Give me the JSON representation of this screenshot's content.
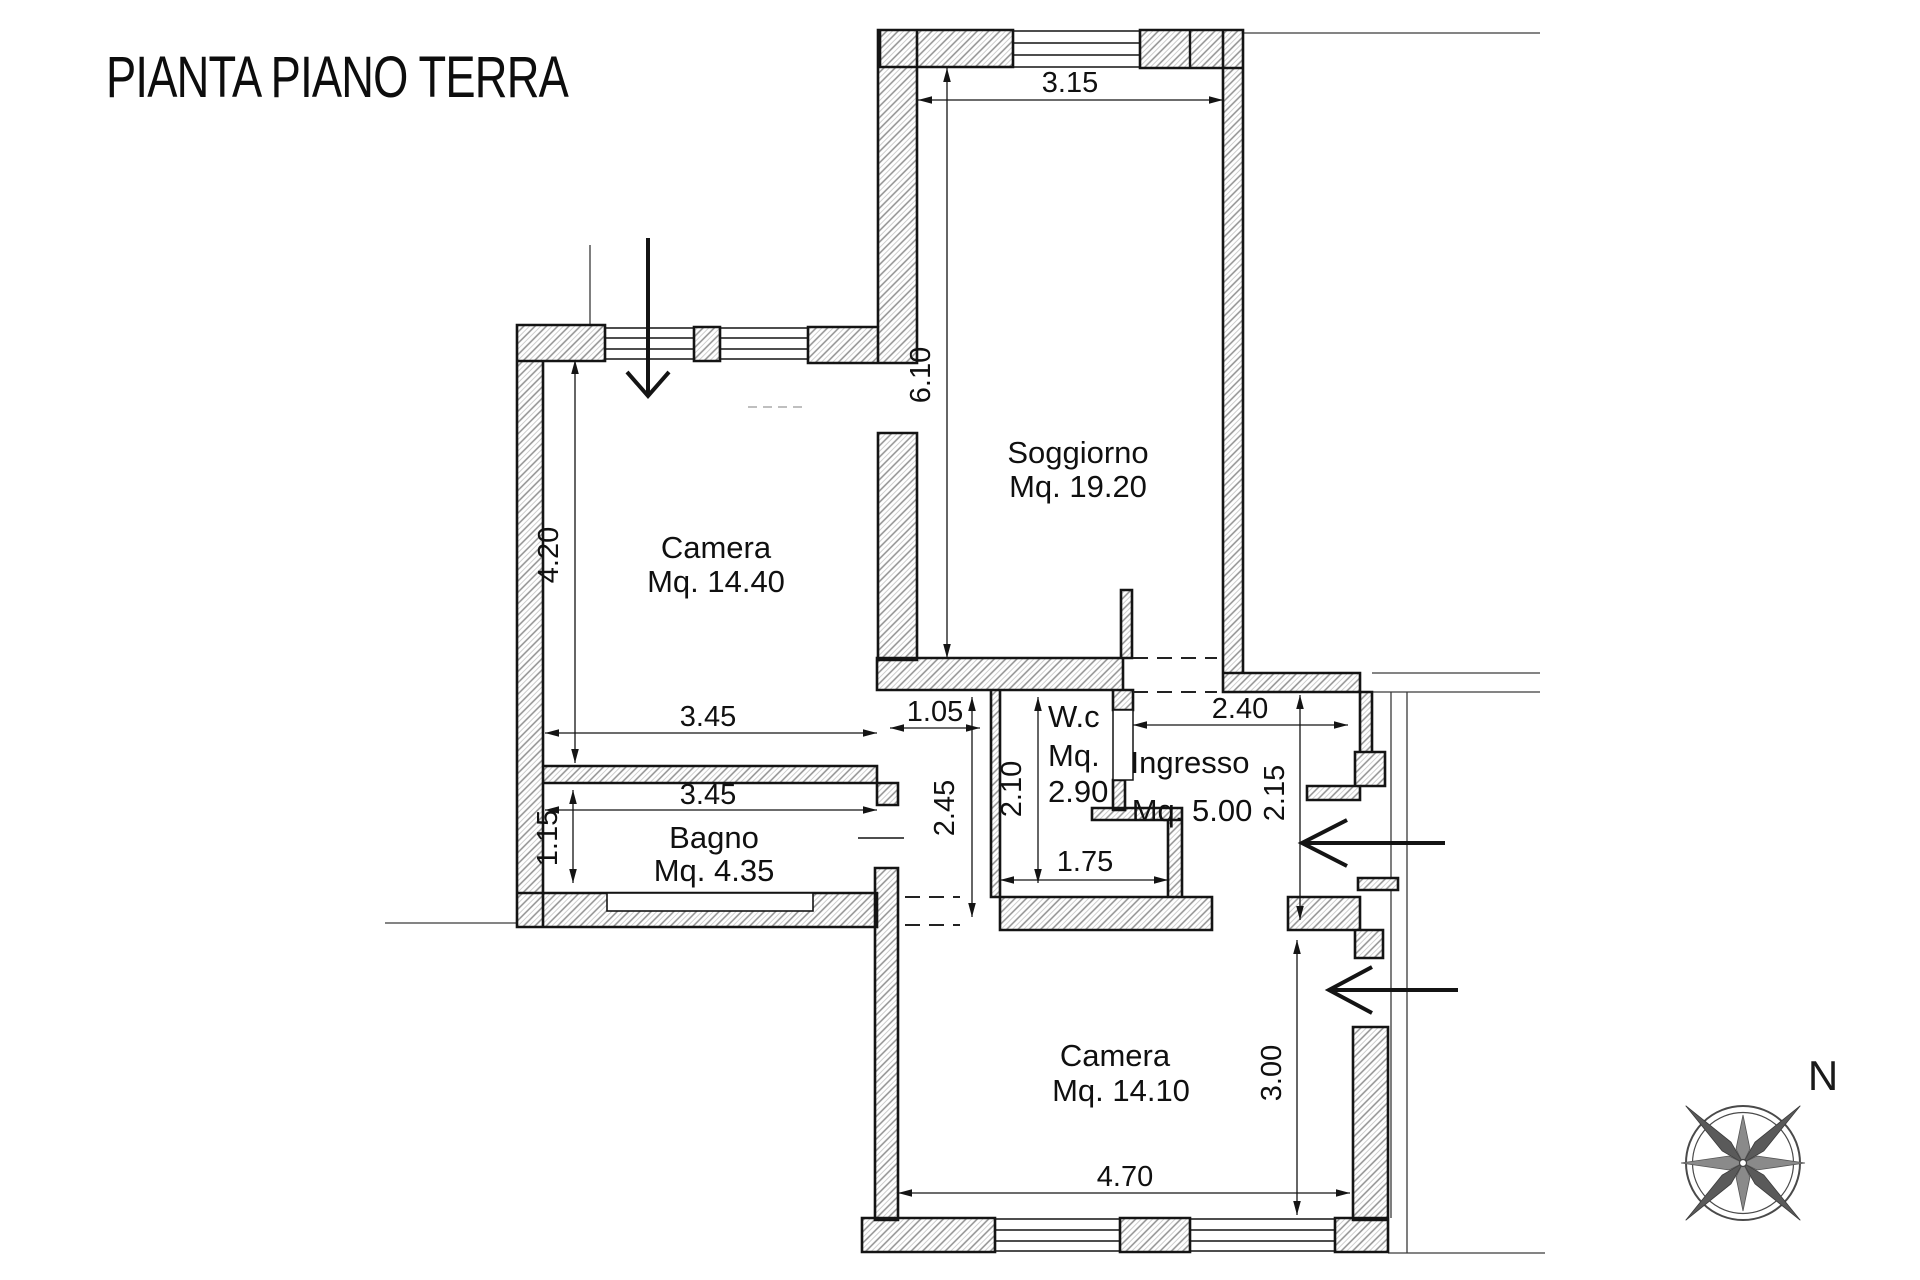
{
  "title": "PIANTA PIANO TERRA",
  "compass": {
    "north": "N"
  },
  "rooms": {
    "camera1": {
      "name": "Camera",
      "area": "Mq. 14.40"
    },
    "soggiorno": {
      "name": "Soggiorno",
      "area": "Mq. 19.20"
    },
    "bagno": {
      "name": "Bagno",
      "area": "Mq. 4.35"
    },
    "wc": {
      "name": "W.c",
      "area_label": "Mq.",
      "area_value": "2.90"
    },
    "ingresso": {
      "name": "Ingresso",
      "area": "Mq. 5.00"
    },
    "camera2": {
      "name": "Camera",
      "area": "Mq. 14.10"
    }
  },
  "dimensions": {
    "soggiorno_width": "3.15",
    "soggiorno_depth": "6.10",
    "camera1_depth": "4.20",
    "camera1_width": "3.45",
    "bagno_width": "3.45",
    "bagno_depth": "1.15",
    "corridor_width": "1.05",
    "corridor_depth": "2.45",
    "wc_depth": "2.10",
    "wc_width": "1.75",
    "ingresso_width": "2.40",
    "ingresso_depth": "2.15",
    "camera2_depth": "3.00",
    "camera2_width": "4.70"
  },
  "colors": {
    "ink": "#141414",
    "hatch": "#8f8f8f",
    "paper": "#ffffff"
  }
}
